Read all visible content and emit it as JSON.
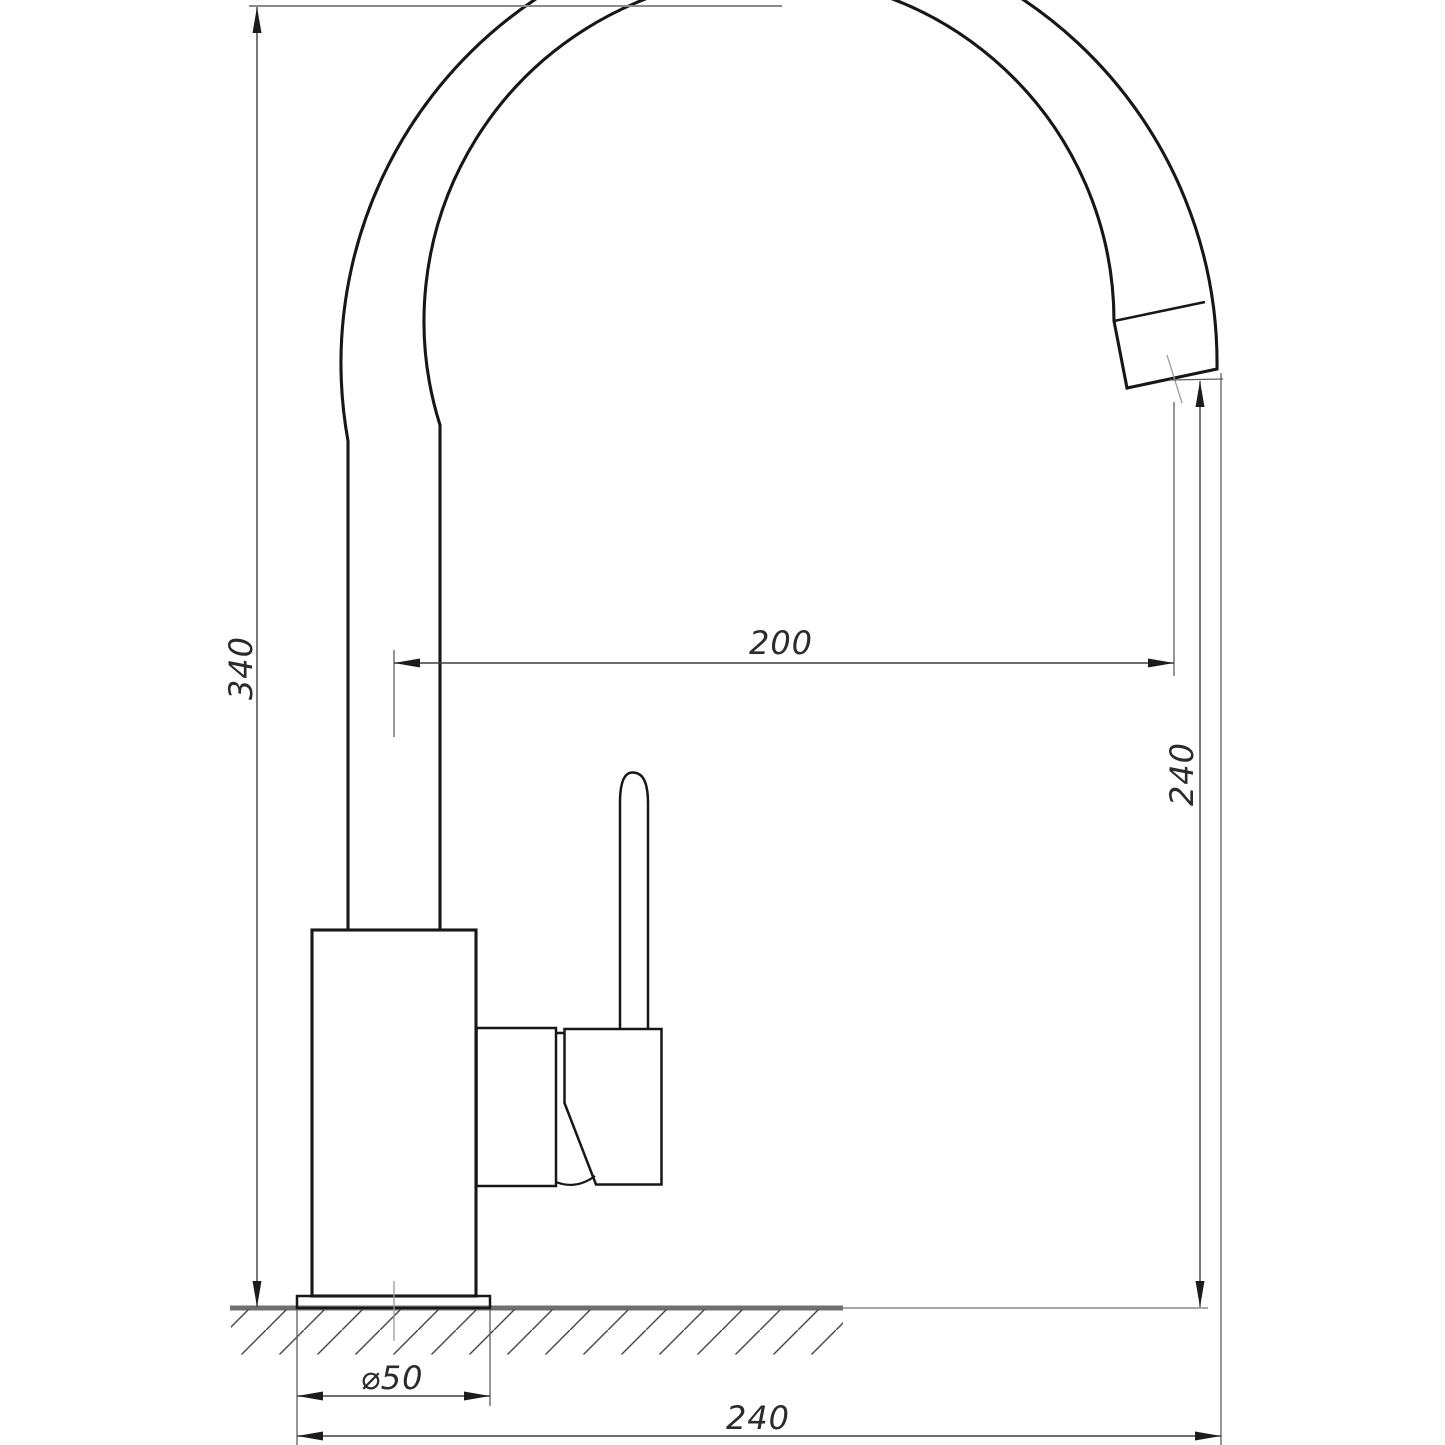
{
  "drawing": {
    "labels": {
      "overall_height": "340",
      "spout_reach": "200",
      "spout_outlet_height": "240",
      "base_diameter": "⌀50",
      "overall_depth": "240"
    },
    "colors": {
      "outline": "#171717",
      "dimension_lines": "#3f3f3f",
      "ground_line": "#6f6f6f",
      "background": "#ffffff"
    }
  }
}
